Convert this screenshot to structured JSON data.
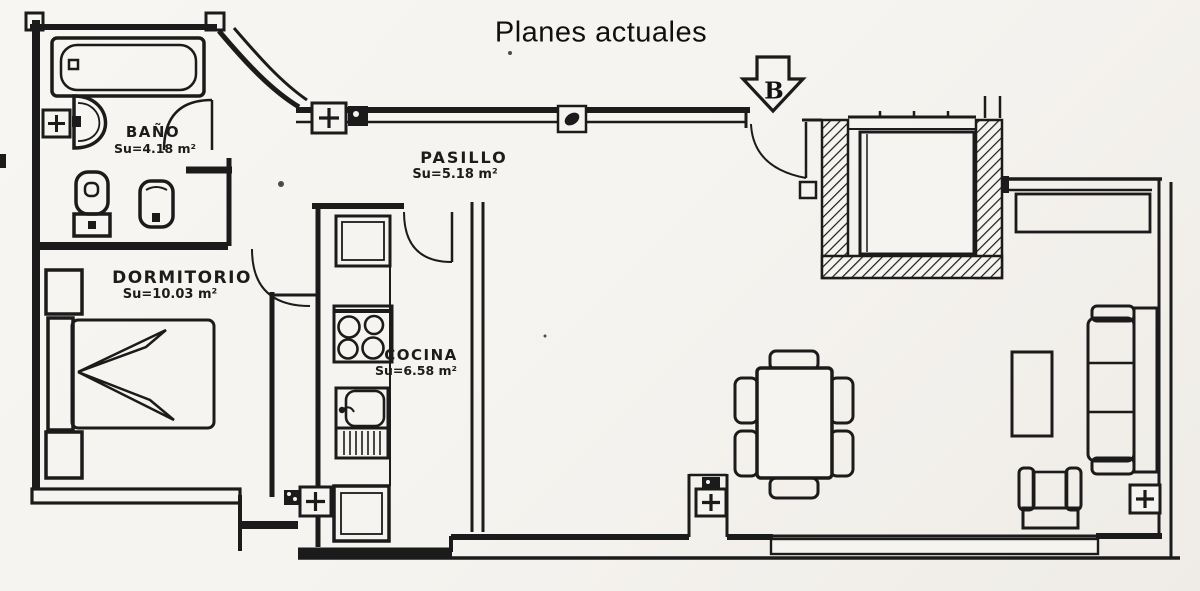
{
  "title": "Planes actuales",
  "north_arrow": {
    "label": "B",
    "direction": "down"
  },
  "rooms": {
    "bano": {
      "name": "BAÑO",
      "area": "Su=4.18 m²"
    },
    "pasillo": {
      "name": "PASILLO",
      "area": "Su=5.18 m²"
    },
    "dormitorio": {
      "name": "DORMITORIO",
      "area": "Su=10.03 m²"
    },
    "cocina": {
      "name": "COCINA",
      "area": "Su=6.58 m²"
    }
  },
  "symbols": {
    "radiator": "+",
    "north_arrow_shape": "outlined down-arrow"
  },
  "fixtures": [
    "bathtub",
    "washbasin",
    "toilet",
    "bidet",
    "double-bed",
    "nightstand",
    "refrigerator",
    "stove-hob",
    "kitchen-sink",
    "dish-drainer",
    "washing-machine",
    "dining-table",
    "dining-chair",
    "sofa",
    "coffee-table",
    "armchair",
    "radiator",
    "patio-shaft",
    "sideboard-cabinet",
    "window-band"
  ],
  "colors": {
    "ink": "#1b1b1b",
    "paper": "#f6f4f0"
  }
}
